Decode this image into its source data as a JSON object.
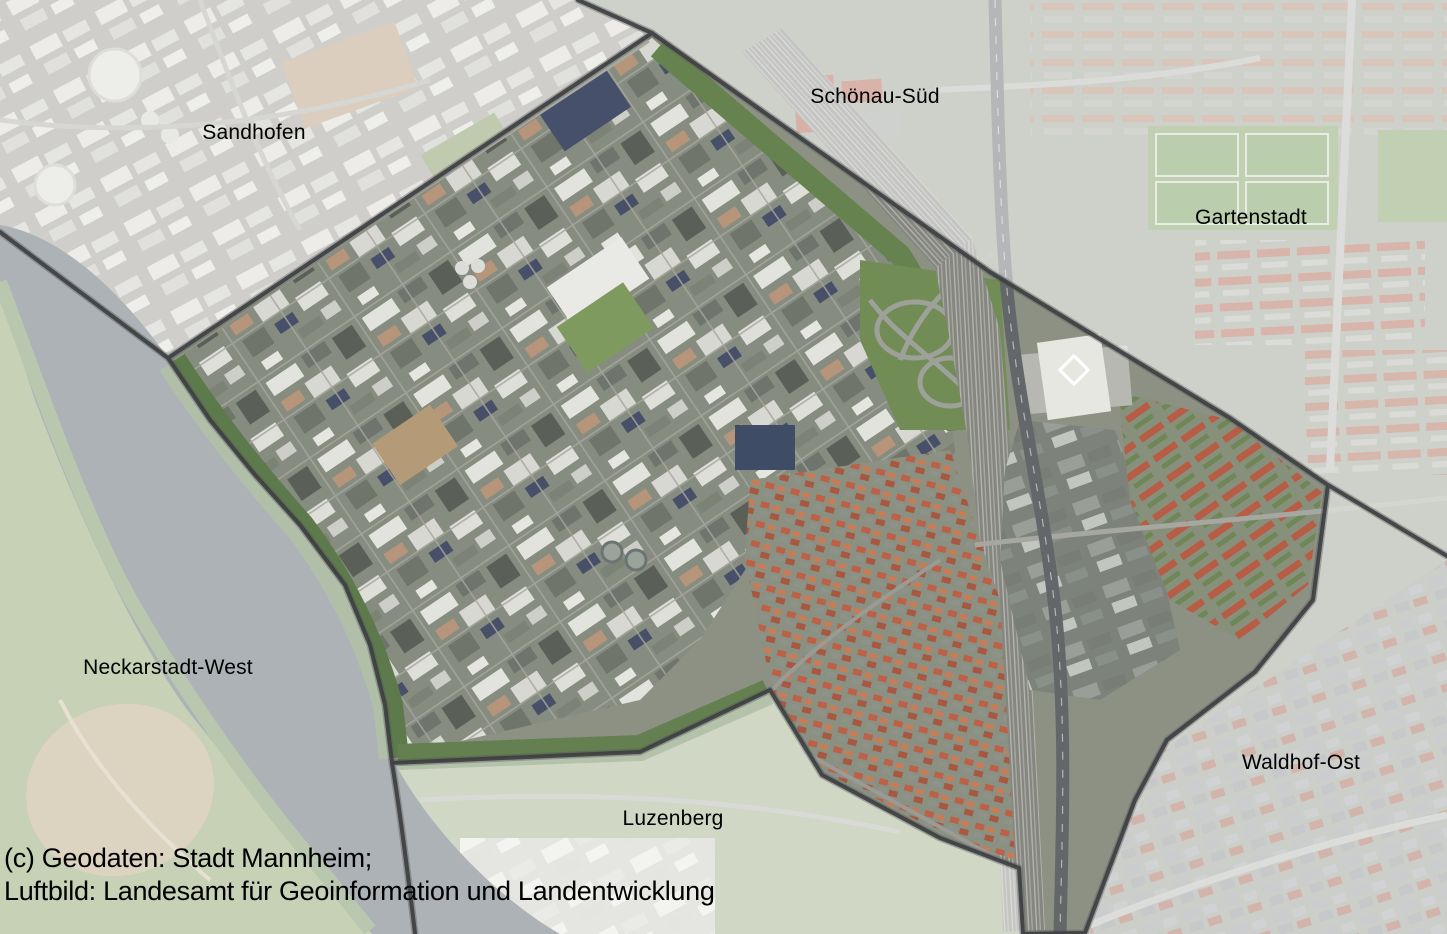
{
  "map": {
    "title": "Mannheim district aerial map",
    "district_labels": [
      {
        "name": "Sandhofen"
      },
      {
        "name": "Schönau-Süd"
      },
      {
        "name": "Gartenstadt"
      },
      {
        "name": "Neckarstadt-West"
      },
      {
        "name": "Luzenberg"
      },
      {
        "name": "Waldhof-Ost"
      }
    ],
    "attribution": {
      "line1": "(c) Geodaten: Stadt Mannheim;",
      "line2": "Luftbild: Landesamt für Geoinformation und Landentwicklung"
    },
    "colors": {
      "district_boundary": "#3c3e40",
      "dim_overlay": "rgba(255,255,255,0.52)",
      "river_water": "#545f66"
    }
  }
}
